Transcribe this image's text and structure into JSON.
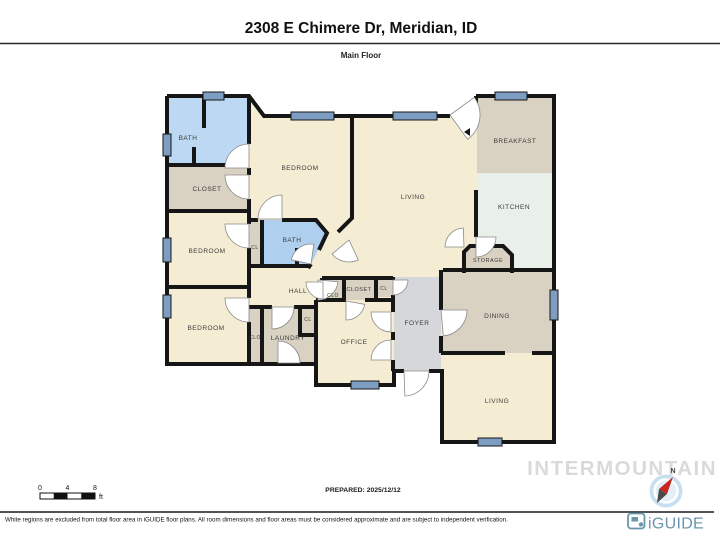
{
  "header": {
    "title": "2308 E Chimere Dr, Meridian, ID",
    "subtitle": "Main Floor"
  },
  "footer": {
    "prepared": "PREPARED: 2025/12/12",
    "disclaimer": "White regions are excluded from total floor area in iGUIDE floor plans. All room dimensions and floor areas must be considered approximate and are subject to independent verification.",
    "watermark": "INTERMOUNTAIN",
    "brand_name": "iGUIDE",
    "compass_label": "N",
    "scale": {
      "labels": [
        "0",
        "4",
        "8"
      ],
      "unit": "ft"
    }
  },
  "colors": {
    "wall": "#161616",
    "cream": "#f5edd3",
    "tan": "#d9d1c2",
    "blue": "#bcd8f2",
    "blue2": "#aed0ee",
    "kitchen": "#e9efe9",
    "foyer": "#d6d7da",
    "window": "#7d9dc2",
    "label": "#3b3b3b",
    "door_stroke": "#8a8a8a",
    "brand": "#6a96ab",
    "watermark": "#dadada",
    "compass_disc": "#c8dff0",
    "compass_inner": "#e4eef7",
    "needle_red": "#c8271f",
    "needle_dark": "#4a4a4a"
  },
  "floorplan": {
    "rooms": [
      {
        "name": "interior-base",
        "fill": "cream",
        "pts": [
          [
            167,
            96
          ],
          [
            249,
            96
          ],
          [
            264,
            116
          ],
          [
            450,
            116
          ],
          [
            476,
            96
          ],
          [
            554,
            96
          ],
          [
            554,
            442
          ],
          [
            442,
            442
          ],
          [
            442,
            371
          ],
          [
            394,
            371
          ],
          [
            394,
            385
          ],
          [
            316,
            385
          ],
          [
            316,
            364
          ],
          [
            167,
            364
          ]
        ]
      },
      {
        "name": "bath-1",
        "fill": "blue",
        "pts": [
          [
            168,
            96
          ],
          [
            249,
            96
          ],
          [
            249,
            165
          ],
          [
            168,
            165
          ]
        ]
      },
      {
        "name": "closet-1",
        "fill": "tan",
        "pts": [
          [
            168,
            165
          ],
          [
            249,
            165
          ],
          [
            249,
            211
          ],
          [
            168,
            211
          ]
        ]
      },
      {
        "name": "cl-strip",
        "fill": "tan",
        "pts": [
          [
            249,
            220
          ],
          [
            262,
            220
          ],
          [
            262,
            266
          ],
          [
            249,
            266
          ]
        ]
      },
      {
        "name": "bath-2",
        "fill": "blue2",
        "pts": [
          [
            262,
            220
          ],
          [
            316,
            220
          ],
          [
            327,
            233
          ],
          [
            311,
            264
          ],
          [
            308,
            268
          ],
          [
            262,
            268
          ]
        ]
      },
      {
        "name": "clo-strip",
        "fill": "tan",
        "pts": [
          [
            249,
            307
          ],
          [
            262,
            307
          ],
          [
            262,
            364
          ],
          [
            249,
            364
          ]
        ]
      },
      {
        "name": "laundry",
        "fill": "tan",
        "pts": [
          [
            262,
            307
          ],
          [
            316,
            307
          ],
          [
            316,
            364
          ],
          [
            262,
            364
          ]
        ]
      },
      {
        "name": "cl-box",
        "fill": "tan",
        "pts": [
          [
            300,
            307
          ],
          [
            316,
            307
          ],
          [
            316,
            335
          ],
          [
            300,
            335
          ]
        ]
      },
      {
        "name": "clo-row",
        "fill": "tan",
        "pts": [
          [
            322,
            278
          ],
          [
            344,
            278
          ],
          [
            344,
            300
          ],
          [
            322,
            300
          ]
        ]
      },
      {
        "name": "closet-row",
        "fill": "tan",
        "pts": [
          [
            344,
            278
          ],
          [
            376,
            278
          ],
          [
            376,
            300
          ],
          [
            344,
            300
          ]
        ]
      },
      {
        "name": "cl-row",
        "fill": "tan",
        "pts": [
          [
            376,
            278
          ],
          [
            393,
            278
          ],
          [
            393,
            297
          ],
          [
            376,
            297
          ]
        ]
      },
      {
        "name": "foyer",
        "fill": "foyer",
        "pts": [
          [
            394,
            277
          ],
          [
            441,
            277
          ],
          [
            441,
            371
          ],
          [
            394,
            371
          ]
        ]
      },
      {
        "name": "breakfast",
        "fill": "tan",
        "pts": [
          [
            477,
            96
          ],
          [
            554,
            96
          ],
          [
            554,
            173
          ],
          [
            477,
            173
          ]
        ]
      },
      {
        "name": "kitchen",
        "fill": "kitchen",
        "pts": [
          [
            477,
            173
          ],
          [
            554,
            173
          ],
          [
            554,
            268
          ],
          [
            477,
            268
          ]
        ]
      },
      {
        "name": "storage",
        "fill": "tan",
        "pts": [
          [
            464,
            252
          ],
          [
            470,
            246
          ],
          [
            503,
            246
          ],
          [
            512,
            255
          ],
          [
            512,
            273
          ],
          [
            464,
            273
          ]
        ]
      },
      {
        "name": "dining",
        "fill": "tan",
        "pts": [
          [
            443,
            270
          ],
          [
            554,
            270
          ],
          [
            554,
            353
          ],
          [
            443,
            353
          ]
        ]
      },
      {
        "name": "living-2",
        "fill": "cream",
        "pts": [
          [
            443,
            353
          ],
          [
            554,
            353
          ],
          [
            554,
            441
          ],
          [
            443,
            441
          ]
        ]
      }
    ],
    "walls": [
      "M167,96 H249 L264,116 H450",
      "M476,96 H554 V442 H442 V371 H429 M404,371 H394 V385 H316 V364 H167 L167,96",
      "M476,96 V110",
      "M167,165 H249",
      "M167,211 H249",
      "M167,287 H249",
      "M204,96 V128",
      "M194,147 V165",
      "M249,96 V144 M249,168 V175 M249,199 V224 M249,248 V298 M249,322 V364",
      "M352,116 V218 L338,232",
      "M249,220 H258 M282,220 H316 L327,233 L319,250 M311,264 L308,268",
      "M262,220 V266",
      "M249,266 H308",
      "M297,248 V267",
      "M249,307 H272 M294,307 H316",
      "M262,307 V364",
      "M300,307 V335 H316",
      "M316,300 V364",
      "M322,278 H393",
      "M322,278 V300",
      "M344,278 V300",
      "M376,278 V300",
      "M316,300 H346 M365,300 H393",
      "M393,277 V280 M393,295 V312 M393,332 V340 M393,360 V371",
      "M441,270 V310 M441,336 V353",
      "M443,270 H554",
      "M441,353 H505 M532,353 H554",
      "M476,190 V237",
      "M464,273 V252 L470,246 H503 L512,255 V273"
    ],
    "windows": [
      [
        203,
        92,
        21,
        8
      ],
      [
        163,
        134,
        8,
        22
      ],
      [
        291,
        112,
        43,
        8
      ],
      [
        393,
        112,
        44,
        8
      ],
      [
        495,
        92,
        32,
        8
      ],
      [
        163,
        238,
        8,
        24
      ],
      [
        163,
        295,
        8,
        23
      ],
      [
        550,
        290,
        8,
        30
      ],
      [
        478,
        438,
        24,
        8
      ],
      [
        351,
        381,
        28,
        8
      ]
    ],
    "doors": [
      [
        249,
        168,
        24,
        180,
        270
      ],
      [
        249,
        175,
        24,
        90,
        180
      ],
      [
        249,
        224,
        24,
        90,
        180
      ],
      [
        249,
        298,
        24,
        90,
        180
      ],
      [
        282,
        219,
        24,
        180,
        270
      ],
      [
        311,
        264,
        20,
        192,
        278
      ],
      [
        272,
        307,
        22,
        0,
        90
      ],
      [
        278,
        363,
        22,
        270,
        360
      ],
      [
        318,
        280,
        20,
        5,
        90
      ],
      [
        391,
        312,
        20,
        90,
        180
      ],
      [
        391,
        360,
        20,
        180,
        270
      ],
      [
        393,
        280,
        15,
        0,
        90
      ],
      [
        323,
        282,
        17,
        90,
        180
      ],
      [
        346,
        301,
        19,
        10,
        90
      ],
      [
        404,
        371,
        25,
        0,
        88
      ],
      [
        441,
        310,
        26,
        0,
        85
      ],
      [
        464,
        247,
        19,
        180,
        268
      ],
      [
        476,
        237,
        20,
        0,
        90
      ],
      [
        450,
        115,
        30,
        -36,
        54
      ],
      [
        349,
        240,
        22,
        65,
        140
      ]
    ],
    "markers": [
      [
        [
          470,
          128
        ],
        [
          470,
          136
        ],
        [
          464,
          132
        ]
      ]
    ],
    "labels": [
      [
        "BATH",
        188,
        140,
        6.5
      ],
      [
        "CLOSET",
        207,
        191,
        6.5
      ],
      [
        "BEDROOM",
        207,
        253,
        6.5
      ],
      [
        "BEDROOM",
        206,
        330,
        6.5
      ],
      [
        "BEDROOM",
        300,
        170,
        6.5
      ],
      [
        "BATH",
        292,
        242,
        6.5
      ],
      [
        "CL",
        255,
        249,
        5
      ],
      [
        "HALL",
        298,
        293,
        6.5
      ],
      [
        "CLO",
        255,
        339,
        5
      ],
      [
        "LAUNDRY",
        288,
        340,
        6.5
      ],
      [
        "CL",
        308,
        321,
        5
      ],
      [
        "CLO",
        333,
        297,
        5
      ],
      [
        "CLOSET",
        359,
        291,
        5.5
      ],
      [
        "CL",
        384,
        290,
        5
      ],
      [
        "OFFICE",
        354,
        344,
        6.5
      ],
      [
        "FOYER",
        417,
        325,
        6.5
      ],
      [
        "STORAGE",
        488,
        262,
        5.5
      ],
      [
        "LIVING",
        413,
        199,
        6.5
      ],
      [
        "BREAKFAST",
        515,
        143,
        6.5
      ],
      [
        "KITCHEN",
        514,
        209,
        6.5
      ],
      [
        "DINING",
        497,
        318,
        6.5
      ],
      [
        "LIVING",
        497,
        403,
        6.5
      ]
    ]
  }
}
